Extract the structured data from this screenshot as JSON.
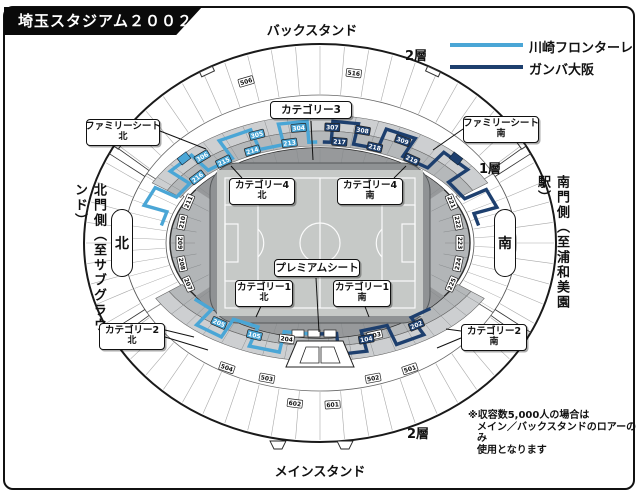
{
  "title": "埼玉スタジアム２００２",
  "colors": {
    "kawasaki": "#4aa6d6",
    "gamba": "#1d3f6e"
  },
  "legend": {
    "items": [
      {
        "label": "川崎フロンターレ",
        "color": "#4aa6d6"
      },
      {
        "label": "ガンバ大阪",
        "color": "#1d3f6e"
      }
    ]
  },
  "stands": {
    "back": "バックスタンド",
    "main": "メインスタンド"
  },
  "tiers": {
    "upper_back": "2層",
    "lower": "1層",
    "upper_main": "2層"
  },
  "gates": {
    "north": "北門側（至サブグラウンド）",
    "south": "南門側（至浦和美園駅）"
  },
  "compass": {
    "north": "北",
    "south": "南"
  },
  "callouts": {
    "family_north": {
      "line1": "ファミリーシート",
      "line2": "北"
    },
    "family_south": {
      "line1": "ファミリーシート",
      "line2": "南"
    },
    "category3": {
      "line1": "カテゴリー3"
    },
    "category4_north": {
      "line1": "カテゴリー4",
      "line2": "北"
    },
    "category4_south": {
      "line1": "カテゴリー4",
      "line2": "南"
    },
    "premium": {
      "line1": "プレミアムシート"
    },
    "category1_north": {
      "line1": "カテゴリー1",
      "line2": "北"
    },
    "category1_south": {
      "line1": "カテゴリー1",
      "line2": "南"
    },
    "category2_north": {
      "line1": "カテゴリー2",
      "line2": "北"
    },
    "category2_south": {
      "line1": "カテゴリー2",
      "line2": "南"
    }
  },
  "note": {
    "line1": "※収容数5,000人の場合は",
    "line2": "メイン／バックスタンドのロアーのみ",
    "line3": "使用となります"
  },
  "section_tags": {
    "white": [
      {
        "label": "506",
        "band": "ringTop",
        "a": -110
      },
      {
        "label": "516",
        "band": "ringTop",
        "a": -81
      },
      {
        "label": "211",
        "band": "side",
        "a": 200
      },
      {
        "label": "210",
        "band": "side",
        "a": 190
      },
      {
        "label": "209",
        "band": "side",
        "a": 180
      },
      {
        "label": "208",
        "band": "side",
        "a": 170
      },
      {
        "label": "207",
        "band": "side",
        "a": 160
      },
      {
        "label": "221",
        "band": "side",
        "a": -20
      },
      {
        "label": "222",
        "band": "side",
        "a": -10
      },
      {
        "label": "223",
        "band": "side",
        "a": 0
      },
      {
        "label": "224",
        "band": "side",
        "a": 10
      },
      {
        "label": "225",
        "band": "side",
        "a": 20
      },
      {
        "label": "204",
        "band": "botMid",
        "a": 102
      },
      {
        "label": "203",
        "band": "botMid",
        "a": 70
      },
      {
        "label": "504",
        "band": "ringBottom",
        "a": 117
      },
      {
        "label": "503",
        "band": "ringBottom",
        "a": 105
      },
      {
        "label": "502",
        "band": "ringBottom",
        "a": 75
      },
      {
        "label": "501",
        "band": "ringBottom",
        "a": 64
      },
      {
        "label": "602",
        "band": "botInner",
        "a": 98
      },
      {
        "label": "601",
        "band": "botInner",
        "a": 86
      }
    ],
    "kawasaki": [
      {
        "label": "306",
        "band": "topA",
        "a": -132
      },
      {
        "label": "305",
        "band": "topA",
        "a": -111
      },
      {
        "label": "304",
        "band": "topA",
        "a": -97
      },
      {
        "label": "216",
        "band": "topB",
        "a": -140
      },
      {
        "label": "215",
        "band": "topB",
        "a": -127
      },
      {
        "label": "214",
        "band": "topB",
        "a": -115
      },
      {
        "label": "213",
        "band": "topB",
        "a": -101
      },
      {
        "label": "205",
        "band": "botCell",
        "a": 127
      },
      {
        "label": "105",
        "band": "botCell",
        "a": 113
      }
    ],
    "gamba": [
      {
        "label": "307",
        "band": "topA",
        "a": -86
      },
      {
        "label": "308",
        "band": "topA",
        "a": -76
      },
      {
        "label": "309",
        "band": "topA",
        "a": -62
      },
      {
        "label": "217",
        "band": "topB",
        "a": -83
      },
      {
        "label": "218",
        "band": "topB",
        "a": -70
      },
      {
        "label": "219",
        "band": "topB",
        "a": -55
      },
      {
        "label": "104",
        "band": "botCell",
        "a": 74
      },
      {
        "label": "202",
        "band": "botCell",
        "a": 55
      }
    ]
  }
}
